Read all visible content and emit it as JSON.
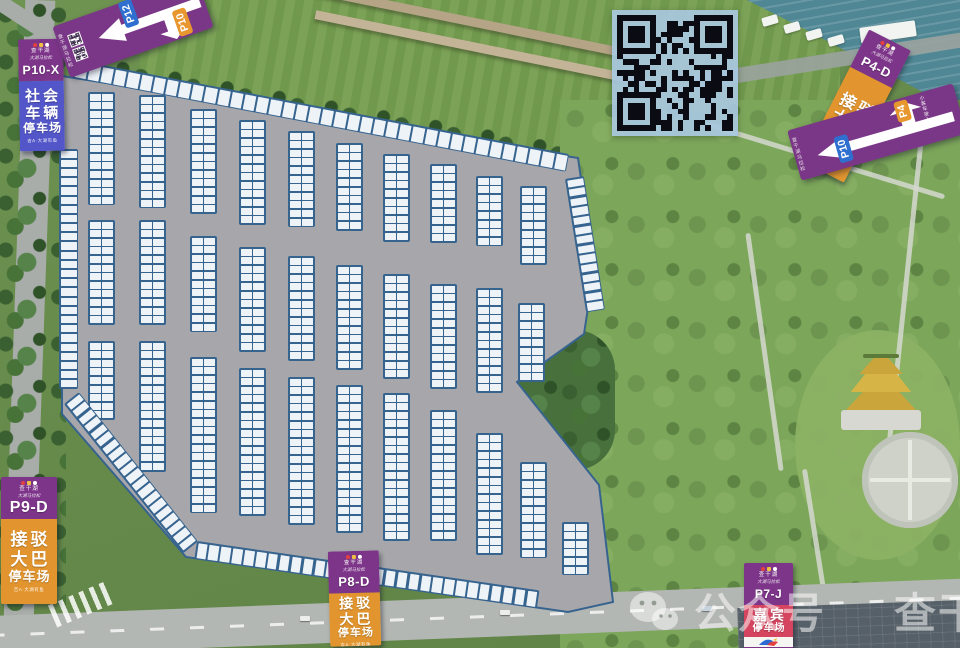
{
  "map": {
    "surface_color": "#a7a7ab",
    "stall_color": "#37648f",
    "outline": "62,76 578,158 594,268 584,334 517,382 599,485 613,602 568,612 186,557 62,414",
    "blocks": [
      [
        88,
        92,
        13
      ],
      [
        139,
        95,
        13
      ],
      [
        190,
        109,
        12
      ],
      [
        239,
        120,
        12
      ],
      [
        288,
        131,
        11
      ],
      [
        336,
        143,
        10
      ],
      [
        383,
        154,
        10
      ],
      [
        430,
        164,
        9
      ],
      [
        476,
        176,
        8
      ],
      [
        520,
        186,
        9
      ],
      [
        88,
        220,
        12
      ],
      [
        139,
        220,
        12
      ],
      [
        190,
        236,
        11
      ],
      [
        239,
        247,
        12
      ],
      [
        288,
        256,
        12
      ],
      [
        336,
        265,
        12
      ],
      [
        383,
        274,
        12
      ],
      [
        430,
        284,
        12
      ],
      [
        476,
        288,
        12
      ],
      [
        518,
        303,
        9
      ],
      [
        88,
        341,
        9
      ],
      [
        139,
        341,
        15
      ],
      [
        190,
        357,
        18
      ],
      [
        239,
        368,
        17
      ],
      [
        288,
        377,
        17
      ],
      [
        336,
        385,
        17
      ],
      [
        383,
        393,
        17
      ],
      [
        430,
        410,
        15
      ],
      [
        476,
        433,
        14
      ],
      [
        520,
        462,
        11
      ],
      [
        562,
        522,
        6
      ]
    ],
    "edges": [
      {
        "type": "row",
        "x": 76,
        "y": 60,
        "count": 38,
        "angle": 10.8,
        "cw": 11.2,
        "ch": 15,
        "gap": 2
      },
      {
        "type": "row",
        "x": 197,
        "y": 541,
        "count": 29,
        "angle": 8.2,
        "cw": 9.5,
        "ch": 15,
        "gap": 2.4
      },
      {
        "type": "col",
        "x": 59,
        "y": 149,
        "count": 26,
        "angle": 0,
        "cw": 16,
        "ch": 7.2,
        "gap": 2
      },
      {
        "type": "col",
        "x": 64,
        "y": 404,
        "count": 20,
        "angle": -38.6,
        "cw": 16,
        "ch": 7.2,
        "gap": 2.3
      },
      {
        "type": "col",
        "x": 565,
        "y": 179,
        "count": 14,
        "angle": -9,
        "cw": 16,
        "ch": 7.3,
        "gap": 2.3
      }
    ]
  },
  "signs": {
    "p10x": {
      "code": "P10-X",
      "header_line1": "查干湖",
      "header_line2": "大湖马拉松",
      "category_lines": [
        "社会",
        "车辆",
        "停车场"
      ],
      "footer": "吉A·大湖有鱼",
      "body_color": "#5356c9"
    },
    "p9d": {
      "code": "P9-D",
      "header_line1": "查干湖",
      "header_line2": "大湖马拉松",
      "category_lines": [
        "接驳",
        "大巴",
        "停车场"
      ],
      "footer": "吉A·大湖有鱼",
      "body_color": "#e2952e"
    },
    "p8d": {
      "code": "P8-D",
      "header_line1": "查干湖",
      "header_line2": "大湖马拉松",
      "category_lines": [
        "接驳",
        "大巴",
        "停车场"
      ],
      "footer": "吉A·大湖有鱼",
      "body_color": "#e2952e"
    },
    "p4d": {
      "code": "P4-D",
      "header_line1": "查干湖",
      "header_line2": "大湖马拉松",
      "category_lines": [
        "接驳",
        "大巴",
        "停车场"
      ],
      "footer": "吉A·大湖有鱼",
      "body_color": "#e2952e"
    },
    "p7j": {
      "code": "P7-J",
      "header_line1": "查干湖",
      "header_line2": "大湖马拉松",
      "category_lines": [
        "嘉宾",
        "停车场"
      ],
      "footer": "吉A·大湖有鱼",
      "body_color": "#d6455f"
    }
  },
  "banners": {
    "top_left": {
      "side_text": "查干湖马拉松",
      "destinations": [
        {
          "label": "P12",
          "color": "#2f6fd0",
          "direction": "left"
        },
        {
          "label": "P10",
          "color": "#e8972f",
          "direction": "down"
        }
      ]
    },
    "right": {
      "side_text": "查干湖马拉松",
      "destinations": [
        {
          "label": "P4",
          "color": "#e8972f",
          "direction": "up",
          "note": "小客车驶入"
        },
        {
          "label": "P10",
          "color": "#2f6fd0",
          "direction": "left"
        }
      ]
    }
  },
  "qr": {
    "modules": 21,
    "seed": 987654
  },
  "watermark": {
    "source": "公众号",
    "account": "查干湖发布"
  }
}
